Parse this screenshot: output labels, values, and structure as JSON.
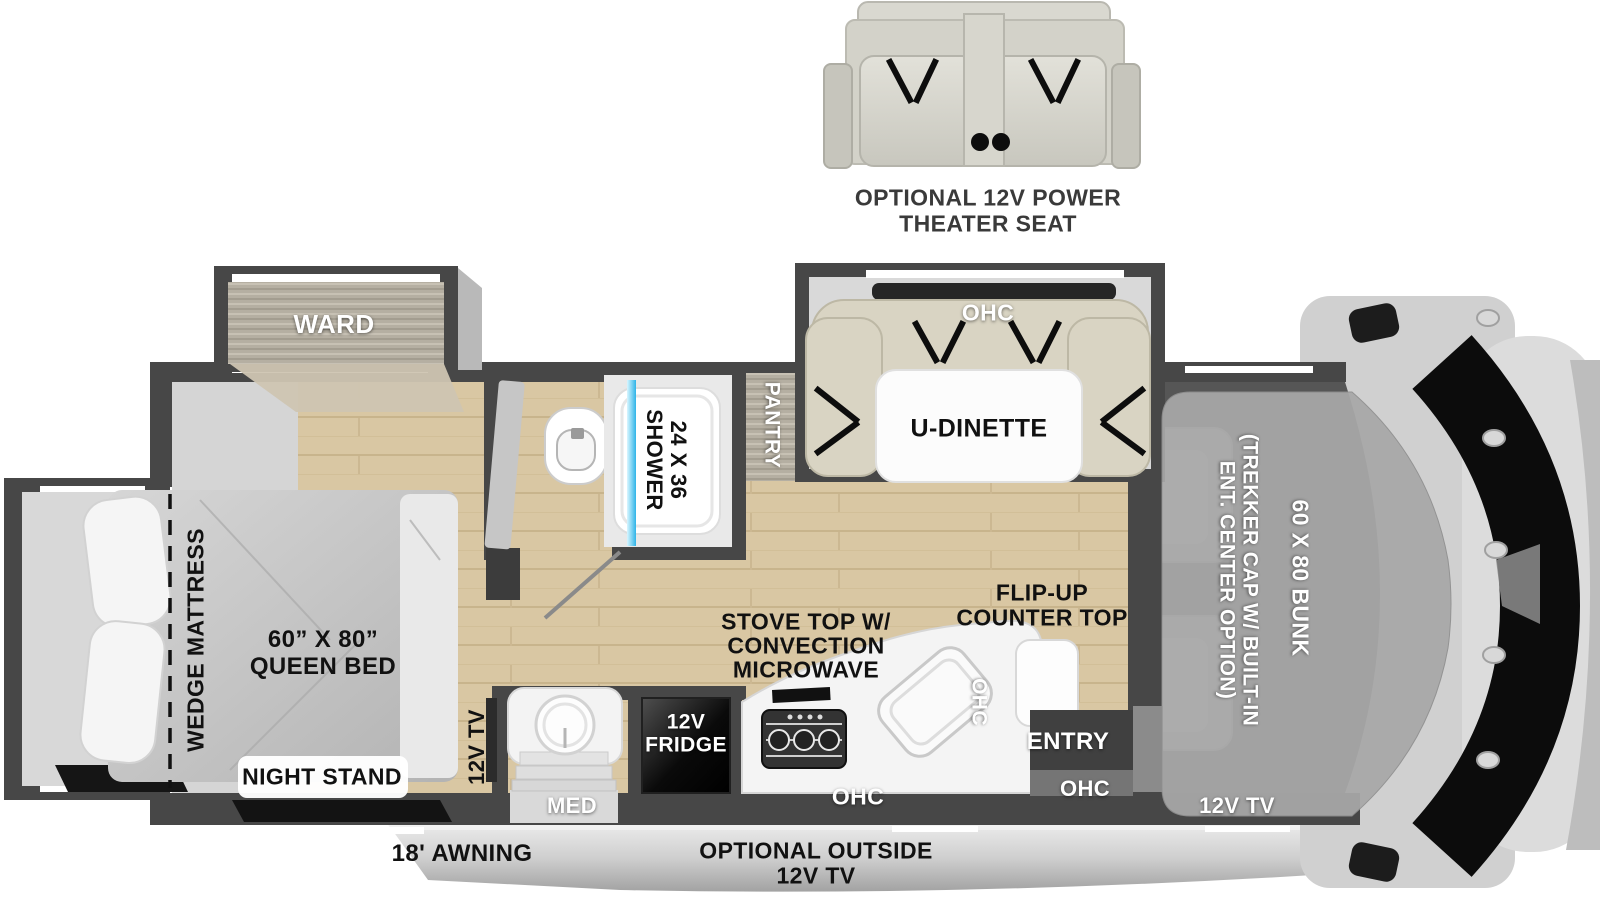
{
  "title": "Class C motorhome floorplan diagram",
  "optional_theater_seat": {
    "line1": "OPTIONAL 12V POWER",
    "line2": "THEATER SEAT"
  },
  "bedroom": {
    "ward": "WARD",
    "wedge_mattress": "WEDGE MATTRESS",
    "queen_bed_line1": "60” X 80”",
    "queen_bed_line2": "QUEEN BED",
    "night_stand": "NIGHT STAND",
    "tv": "12V TV"
  },
  "bathroom": {
    "shower_line1": "24 X 36",
    "shower_line2": "SHOWER",
    "med": "MED"
  },
  "kitchen": {
    "pantry": "PANTRY",
    "fridge_line1": "12V",
    "fridge_line2": "FRIDGE",
    "stove_line1": "STOVE TOP W/",
    "stove_line2": "CONVECTION",
    "stove_line3": "MICROWAVE",
    "ohc": "OHC",
    "counter_ohc": "OHC",
    "flip_up_line1": "FLIP-UP",
    "flip_up_line2": "COUNTER TOP"
  },
  "dinette": {
    "label": "U-DINETTE",
    "ohc": "OHC"
  },
  "entry": {
    "label": "ENTRY",
    "ohc": "OHC"
  },
  "front": {
    "bunk": "60 X 80 BUNK",
    "trekker_line1": "(TREKKER CAP W/ BUILT-IN",
    "trekker_line2": "ENT. CENTER OPTION)",
    "tv": "12V TV"
  },
  "exterior": {
    "awning": "18' AWNING",
    "outside_tv_line1": "OPTIONAL OUTSIDE",
    "outside_tv_line2": "12V TV"
  },
  "colors": {
    "wall": "#474747",
    "wood_floor": "#d9c7a3",
    "slide_floor": "#d8d8d8",
    "cockpit_floor": "#565656",
    "shower_glass": "#2fb4e8",
    "sofa_beige": "#d9d4c3",
    "exterior_band": "#bdbdbd"
  }
}
